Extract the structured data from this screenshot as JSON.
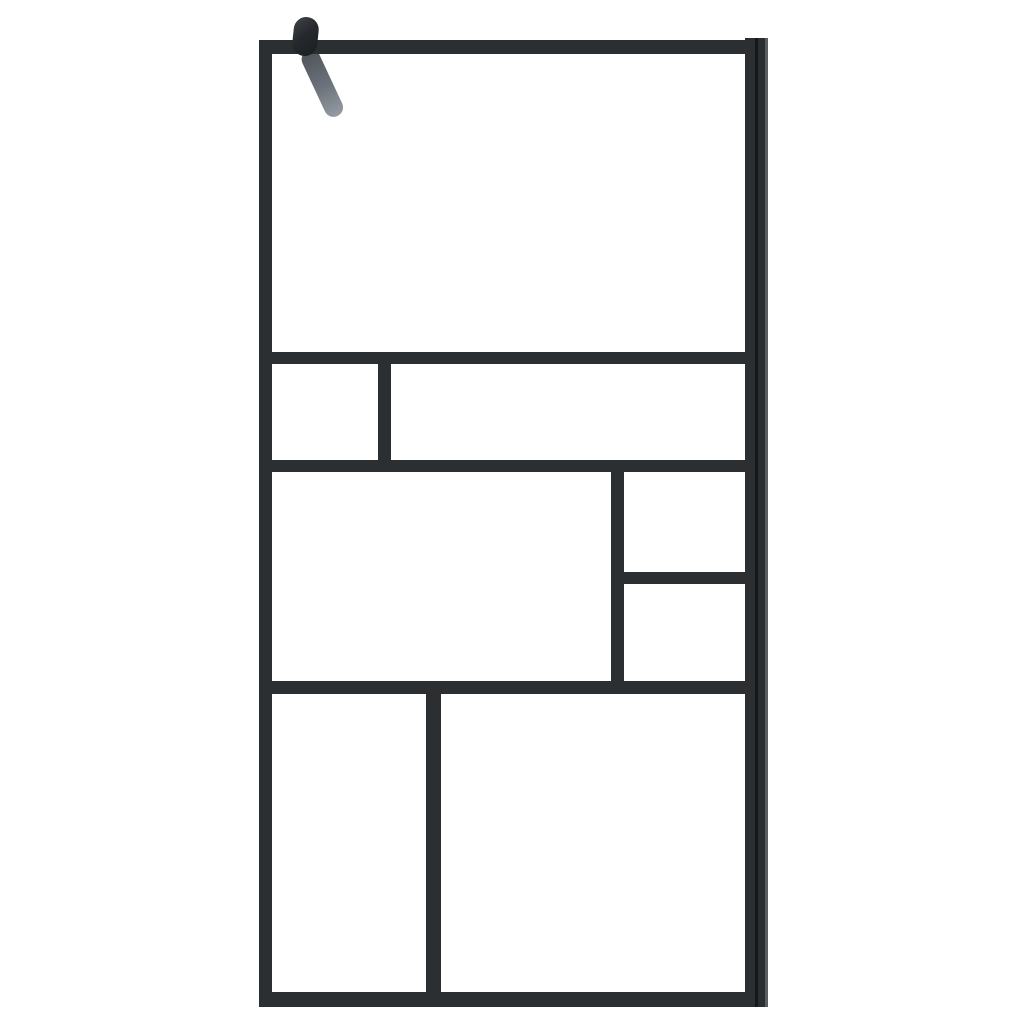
{
  "scene": {
    "subject": "walk-in-shower-glass-screen",
    "description": "Walk-in shower screen: transparent glass with matte black aluminium frame grid, wall profile on the right side and a black mounting knob with grey support arm at the top left",
    "background_color": "#ffffff",
    "glass_color": "#ffffff",
    "frame_color": "#2c2f32",
    "colors": {
      "frame_seam_dark": "#15171a",
      "profile_highlight": "#5a5e63",
      "knob_dark": "#1b1e21",
      "knob_light": "#41464b",
      "arm_top": "#4e535a",
      "arm_mid": "#6d737a",
      "arm_tip": "#959ba2"
    },
    "glass_panes": [
      {
        "name": "glass-pane-top",
        "x": 272,
        "y": 54,
        "w": 473,
        "h": 298
      },
      {
        "name": "glass-pane-row2-left-small",
        "x": 272,
        "y": 364,
        "w": 106,
        "h": 96
      },
      {
        "name": "glass-pane-row2-right-wide",
        "x": 391,
        "y": 364,
        "w": 354,
        "h": 96
      },
      {
        "name": "glass-pane-row3-left-large",
        "x": 272,
        "y": 472,
        "w": 339,
        "h": 209
      },
      {
        "name": "glass-pane-row3-right-upper",
        "x": 624,
        "y": 472,
        "w": 121,
        "h": 100
      },
      {
        "name": "glass-pane-row3-right-lower",
        "x": 624,
        "y": 584,
        "w": 121,
        "h": 97
      },
      {
        "name": "glass-pane-bottom-left",
        "x": 272,
        "y": 694,
        "w": 154,
        "h": 298
      },
      {
        "name": "glass-pane-bottom-right",
        "x": 441,
        "y": 694,
        "w": 304,
        "h": 298
      }
    ],
    "frame_bars": [
      {
        "name": "frame-top-bar",
        "x": 259,
        "y": 40,
        "w": 494,
        "h": 14
      },
      {
        "name": "frame-left-bar",
        "x": 259,
        "y": 40,
        "w": 13,
        "h": 967
      },
      {
        "name": "frame-bottom-bar",
        "x": 259,
        "y": 992,
        "w": 509,
        "h": 15
      },
      {
        "name": "frame-right-wall-profile",
        "x": 745,
        "y": 38,
        "w": 23,
        "h": 969,
        "gradient": "linear-gradient(to right, #2c2f32 0px, #2c2f32 10px, #15171a 10px, #15171a 13px, #2b2e31 13px, #2b2e31 20px, #5a5e63 20px, #5a5e63 23px)"
      },
      {
        "name": "mullion-h1-full-width",
        "x": 266,
        "y": 352,
        "w": 486,
        "h": 12
      },
      {
        "name": "mullion-v1-row2-divider",
        "x": 378,
        "y": 352,
        "w": 13,
        "h": 120
      },
      {
        "name": "mullion-h2-full-width",
        "x": 266,
        "y": 460,
        "w": 486,
        "h": 12
      },
      {
        "name": "mullion-v2-row3-divider",
        "x": 611,
        "y": 460,
        "w": 13,
        "h": 234
      },
      {
        "name": "mullion-h3-right-split",
        "x": 617,
        "y": 572,
        "w": 133,
        "h": 12
      },
      {
        "name": "mullion-h4-full-width",
        "x": 266,
        "y": 681,
        "w": 486,
        "h": 13
      },
      {
        "name": "mullion-v3-bottom-divider",
        "x": 426,
        "y": 681,
        "w": 15,
        "h": 326
      }
    ],
    "bracket": {
      "knob_name": "mount-knob",
      "arm_name": "support-arm"
    }
  }
}
